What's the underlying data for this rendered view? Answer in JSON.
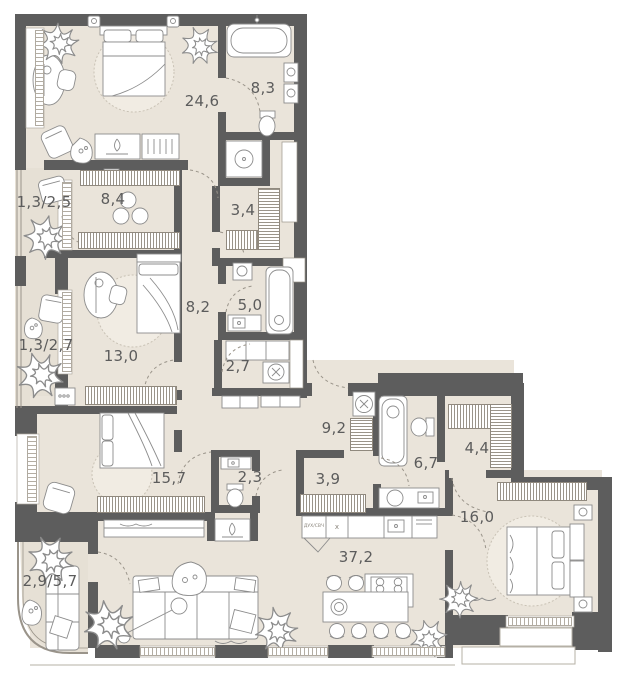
{
  "palette": {
    "floor": "#eae4da",
    "balcony_floor": "#e6e0d5",
    "wall": "#5d5d5d",
    "furniture_line": "#8c8c8c",
    "rug": "#f1ece3"
  },
  "rooms": [
    {
      "id": "master-bedroom",
      "area": "24,6"
    },
    {
      "id": "master-bathroom",
      "area": "8,3"
    },
    {
      "id": "balcony-1",
      "area": "1,3/2,5"
    },
    {
      "id": "wardrobe-1",
      "area": "8,4"
    },
    {
      "id": "closet-1",
      "area": "3,4"
    },
    {
      "id": "corridor",
      "area": "8,2"
    },
    {
      "id": "bathroom-2",
      "area": "5,0"
    },
    {
      "id": "balcony-2",
      "area": "1,3/2,7"
    },
    {
      "id": "bedroom-2",
      "area": "13,0"
    },
    {
      "id": "laundry",
      "area": "2,7"
    },
    {
      "id": "entry-hall",
      "area": "9,2"
    },
    {
      "id": "bedroom-3",
      "area": "15,7"
    },
    {
      "id": "wc",
      "area": "2,3"
    },
    {
      "id": "closet-2",
      "area": "3,9"
    },
    {
      "id": "bathroom-3",
      "area": "6,7"
    },
    {
      "id": "wardrobe-2",
      "area": "4,4"
    },
    {
      "id": "bedroom-4",
      "area": "16,0"
    },
    {
      "id": "balcony-3",
      "area": "2,9/5,7"
    },
    {
      "id": "living-kitchen",
      "area": "37,2"
    }
  ],
  "appliances": {
    "oven_label": "ДУХ/СВЧ",
    "hob_label": "x"
  }
}
